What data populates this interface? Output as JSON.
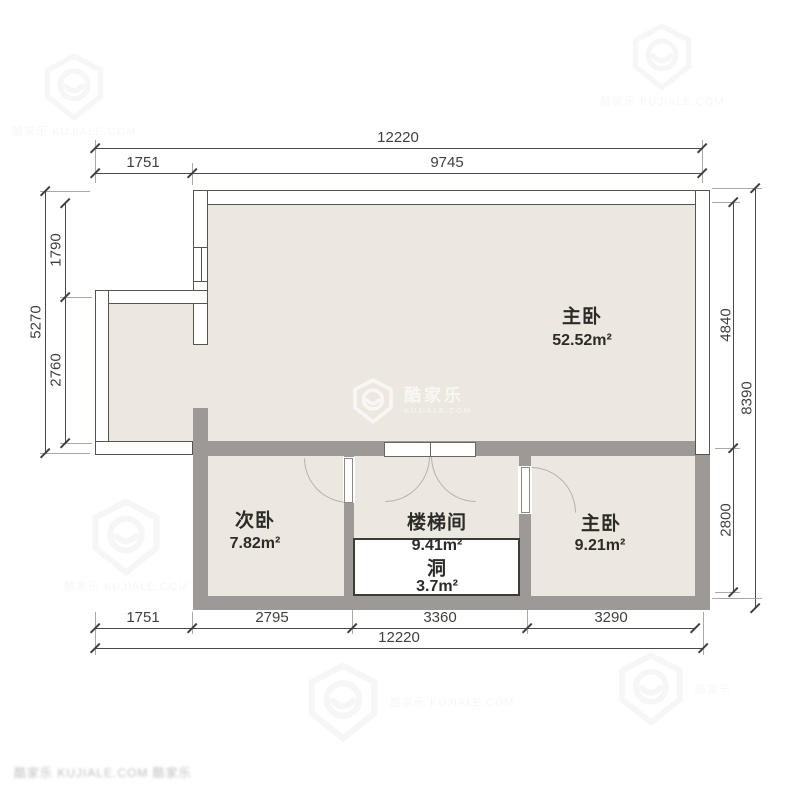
{
  "plan": {
    "rooms": [
      {
        "name": "主卧",
        "area": "52.52m²"
      },
      {
        "name": "次卧",
        "area": "7.82m²"
      },
      {
        "name": "楼梯间",
        "area": "9.41m²"
      },
      {
        "name": "洞",
        "area": "3.7m²"
      },
      {
        "name": "主卧",
        "area": "9.21m²"
      }
    ],
    "dimensions": {
      "top": {
        "total": "12220",
        "segments": [
          "1751",
          "9745"
        ]
      },
      "bottom": {
        "total": "12220",
        "segments": [
          "1751",
          "2795",
          "3360",
          "3290"
        ]
      },
      "left": {
        "total": "5270",
        "segments": [
          "1790",
          "2760"
        ]
      },
      "right": {
        "total": "8390",
        "segments": [
          "4840",
          "2800"
        ]
      }
    }
  },
  "watermark": {
    "brand": "酷家乐",
    "domain": "KUJIALE.COM",
    "corner_text": "酷家乐 KUJIALE.COM 酷家乐"
  },
  "colors": {
    "floor": "#ece8e0",
    "wall_gray": "#9c9996",
    "wall_outline": "#57534d",
    "dim_text": "#3f3f3d"
  }
}
